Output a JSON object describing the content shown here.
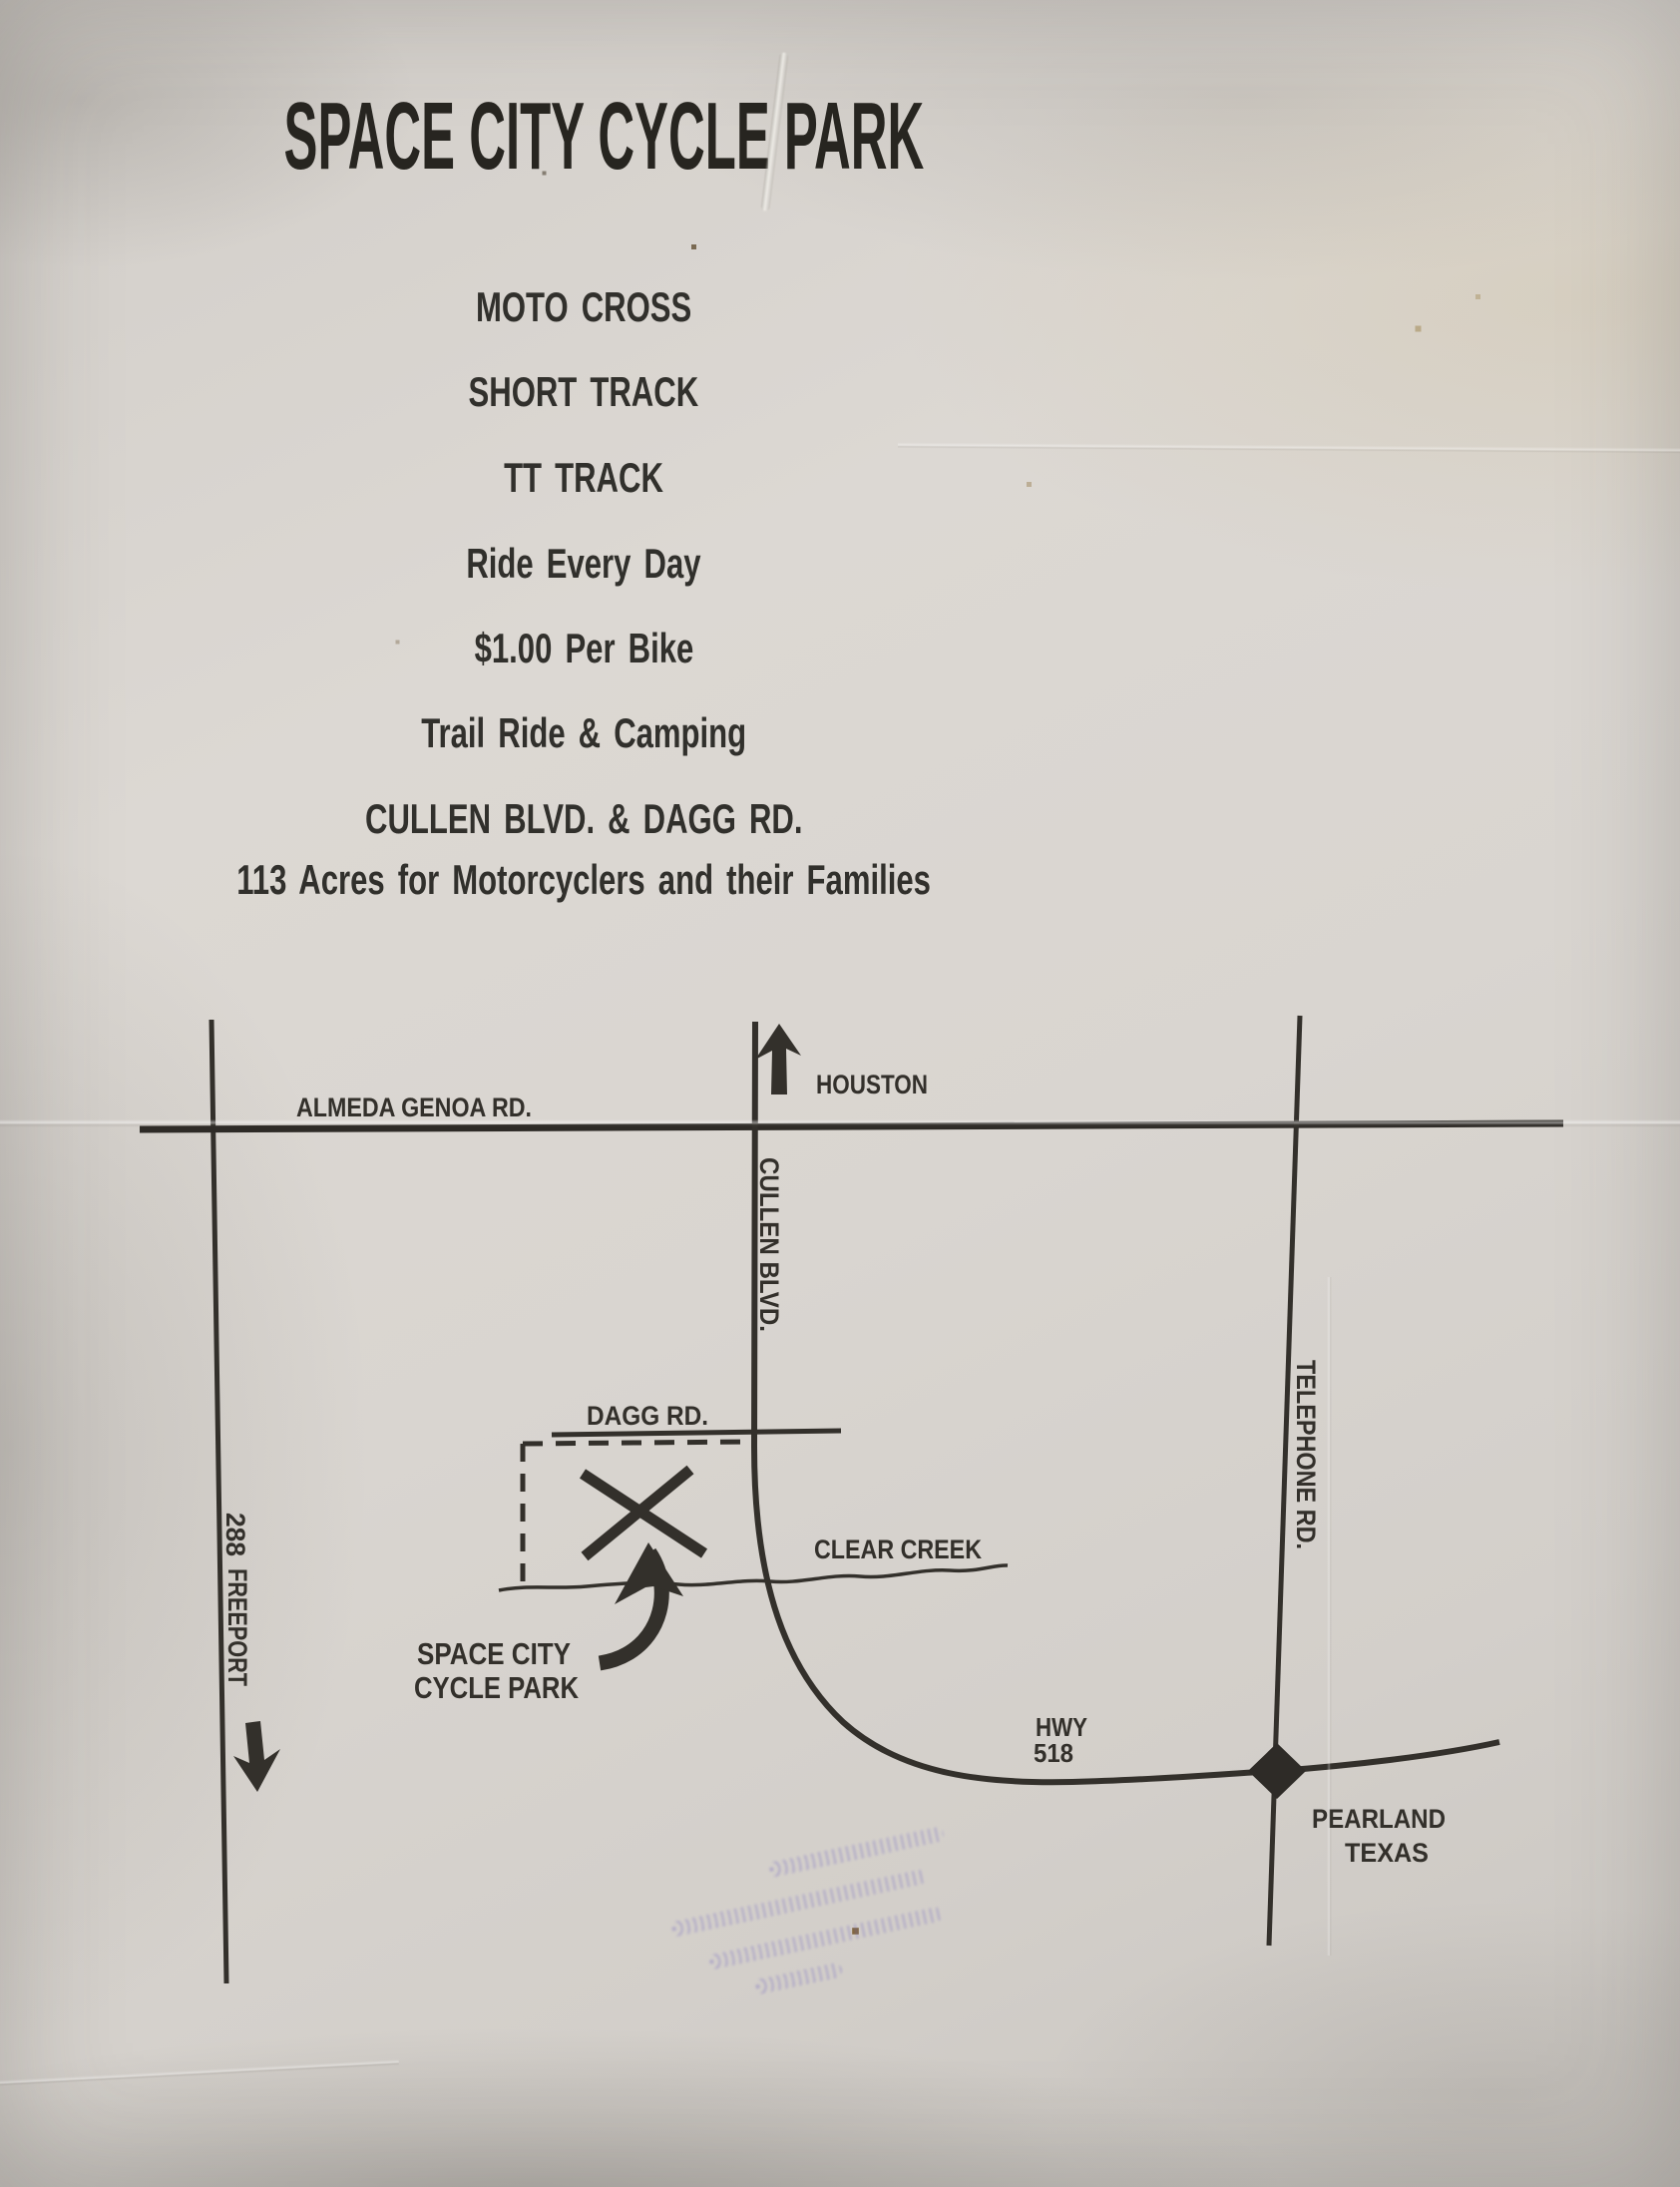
{
  "header": {
    "title": "SPACE CITY CYCLE PARK",
    "line1": "MOTO CROSS",
    "line2": "SHORT TRACK",
    "line3": "TT TRACK",
    "line4": "Ride Every Day",
    "line5": "$1.00 Per Bike",
    "line6": "Trail Ride & Camping",
    "line7": "CULLEN BLVD. & DAGG RD.",
    "line8": "113 Acres for Motorcyclers and their Families"
  },
  "map": {
    "ink_color": "#33302b",
    "labels": {
      "almeda": "ALMEDA GENOA RD.",
      "houston": "HOUSTON",
      "cullen": "CULLEN BLVD.",
      "dagg": "DAGG RD.",
      "clear_creek": "CLEAR CREEK",
      "telephone": "TELEPHONE RD.",
      "freeport_number": "288",
      "freeport_name": "FREEPORT",
      "park_line1": "SPACE CITY",
      "park_line2": "CYCLE PARK",
      "hwy_line1": "HWY",
      "hwy_line2": "518",
      "pearland_line1": "PEARLAND",
      "pearland_line2": "TEXAS"
    }
  },
  "colors": {
    "paper": "#d8d4cf",
    "ink": "#33302b",
    "stamp": "#7064c0"
  }
}
